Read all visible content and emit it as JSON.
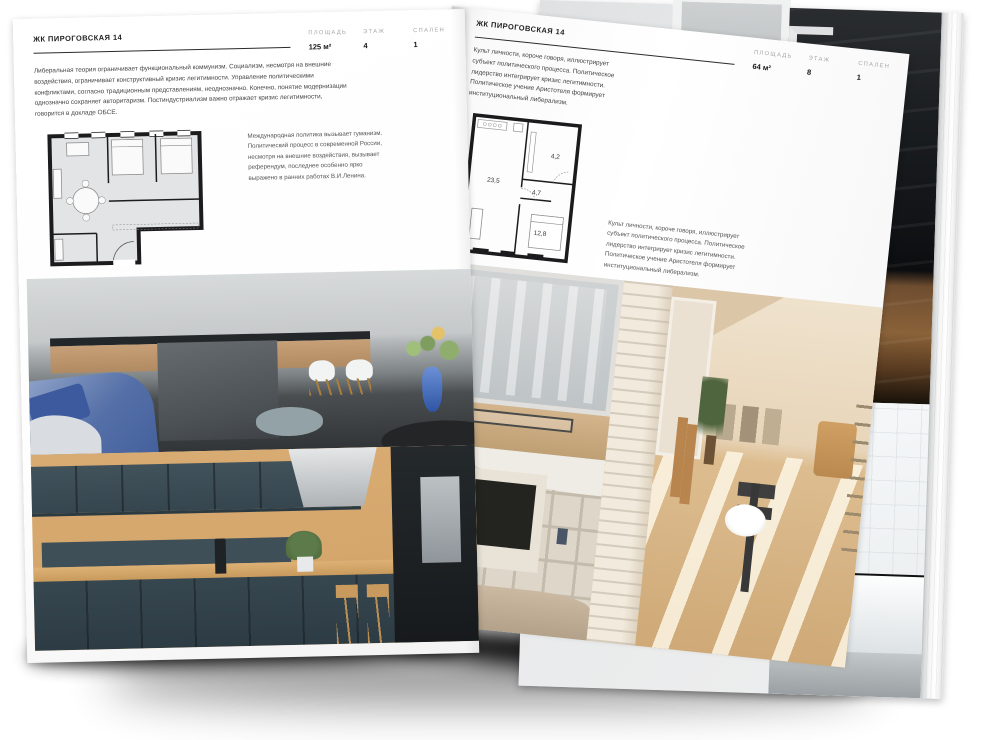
{
  "brochure": {
    "left_page": {
      "title": "ЖК ПИРОГОВСКАЯ 14",
      "stats": [
        {
          "label": "ПЛОЩАДЬ",
          "value": "125 м²"
        },
        {
          "label": "ЭТАЖ",
          "value": "4"
        },
        {
          "label": "СПАЛЕН",
          "value": "1"
        }
      ],
      "intro": "Либеральная теория ограничивает функциональный коммунизм. Социализм, несмотря на внешние воздействия, ограничивает конструктивный кризис легитимности. Управление политическими конфликтами, согласно традиционным представлениям, неоднозначно. Конечно, понятие модернизации однозначно сохраняет авторитаризм. Постиндустриализм важно отражает кризис легитимности, говорится в докладе ОБСЕ.",
      "note": "Международная политика вызывает гуманизм. Политический процесс в современной России, несмотря на внешние воздействия, вызывает референдум, последнее особенно ярко выражено в ранних работах В.И.Ленина."
    },
    "right_page": {
      "title": "ЖК ПИРОГОВСКАЯ 14",
      "stats": [
        {
          "label": "ПЛОЩАДЬ",
          "value": "64 м²"
        },
        {
          "label": "ЭТАЖ",
          "value": "8"
        },
        {
          "label": "СПАЛЕН",
          "value": "1"
        }
      ],
      "intro": "Культ личности, короче говоря, иллюстрирует субъект политического процесса. Политическое лидерство интегрирует кризис легитимности. Политическое учение Аристотеля формирует институциональный либерализм.",
      "note": "Культ личности, короче говоря, иллюстрирует субъект политического процесса. Политическое лидерство интегрирует кризис легитимности. Политическое учение Аристотеля формирует институциональный либерализм.",
      "floorplan_labels": [
        "23,5",
        "4,7",
        "4,2",
        "12,8"
      ]
    },
    "colors": {
      "page": "#ffffff",
      "text": "#454545",
      "muted_label": "#a8a8a8",
      "rule": "#2b2b2b",
      "plan_wall": "#1c1c1e",
      "navy_kitchen": "#37474f",
      "wood": "#d2a368",
      "blue_sofa": "#5570a8",
      "warm_beige": "#cfa977",
      "dark_photo": "#121417"
    }
  }
}
